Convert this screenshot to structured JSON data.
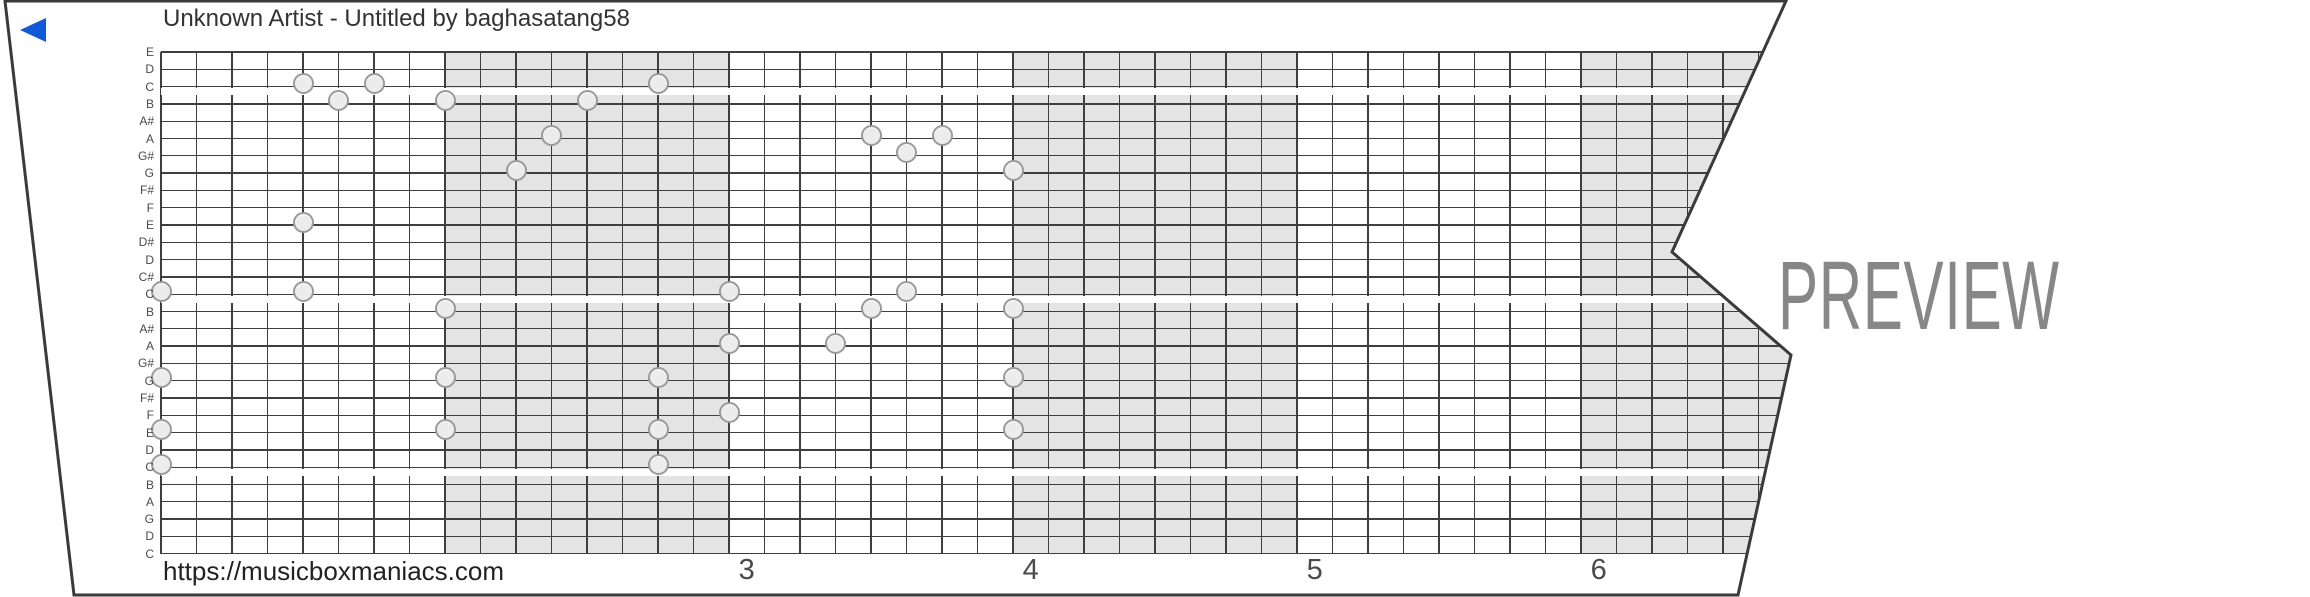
{
  "title": "Unknown Artist - Untitled by baghasatang58",
  "watermark": "PREVIEW",
  "footer_url": "https://musicboxmaniacs.com",
  "play_button": {
    "name": "play",
    "color": "#1259d8"
  },
  "colors": {
    "paper_border": "#3a3a3a",
    "grid_line": "#3f3f3f",
    "measure_shading": "#e4e4e4",
    "note_fill": "#ececec",
    "note_border": "#9a9a9a",
    "label_text": "#4a4a4a",
    "watermark_text": "#878787",
    "title_text": "#333333"
  },
  "strip": {
    "pitch_labels": [
      "E",
      "D",
      "C",
      "B",
      "A#",
      "A",
      "G#",
      "G",
      "F#",
      "F",
      "E",
      "D#",
      "D",
      "C#",
      "C",
      "B",
      "A#",
      "A",
      "G#",
      "G",
      "F#",
      "F",
      "E",
      "D",
      "C",
      "B",
      "A",
      "G",
      "D",
      "C"
    ],
    "octave_stripe_rows": [
      2,
      14,
      24
    ],
    "shaded_measures": [
      {
        "from_col": 8,
        "to_col": 16
      },
      {
        "from_col": 24,
        "to_col": 32
      },
      {
        "from_col": 40,
        "to_col": 47
      }
    ],
    "measure_numbers": [
      {
        "label": "3",
        "col": 16.5
      },
      {
        "label": "4",
        "col": 24.5
      },
      {
        "label": "5",
        "col": 32.5
      },
      {
        "label": "6",
        "col": 40.5
      }
    ],
    "notes": [
      {
        "col": 0,
        "row": 14,
        "pitch": "C"
      },
      {
        "col": 0,
        "row": 19,
        "pitch": "G"
      },
      {
        "col": 0,
        "row": 22,
        "pitch": "E"
      },
      {
        "col": 0,
        "row": 24,
        "pitch": "C"
      },
      {
        "col": 4,
        "row": 2,
        "pitch": "C"
      },
      {
        "col": 4,
        "row": 10,
        "pitch": "E"
      },
      {
        "col": 4,
        "row": 14,
        "pitch": "C"
      },
      {
        "col": 5,
        "row": 3,
        "pitch": "B"
      },
      {
        "col": 6,
        "row": 2,
        "pitch": "C"
      },
      {
        "col": 8,
        "row": 3,
        "pitch": "B"
      },
      {
        "col": 8,
        "row": 15,
        "pitch": "B"
      },
      {
        "col": 8,
        "row": 19,
        "pitch": "G"
      },
      {
        "col": 8,
        "row": 22,
        "pitch": "E"
      },
      {
        "col": 10,
        "row": 7,
        "pitch": "G"
      },
      {
        "col": 11,
        "row": 5,
        "pitch": "A"
      },
      {
        "col": 12,
        "row": 3,
        "pitch": "B"
      },
      {
        "col": 14,
        "row": 2,
        "pitch": "C"
      },
      {
        "col": 14,
        "row": 19,
        "pitch": "G"
      },
      {
        "col": 14,
        "row": 22,
        "pitch": "E"
      },
      {
        "col": 14,
        "row": 24,
        "pitch": "C"
      },
      {
        "col": 16,
        "row": 14,
        "pitch": "C"
      },
      {
        "col": 16,
        "row": 17,
        "pitch": "A"
      },
      {
        "col": 16,
        "row": 21,
        "pitch": "F"
      },
      {
        "col": 19,
        "row": 17,
        "pitch": "A"
      },
      {
        "col": 20,
        "row": 5,
        "pitch": "A"
      },
      {
        "col": 20,
        "row": 15,
        "pitch": "B"
      },
      {
        "col": 21,
        "row": 6,
        "pitch": "G#"
      },
      {
        "col": 21,
        "row": 14,
        "pitch": "C"
      },
      {
        "col": 22,
        "row": 5,
        "pitch": "A"
      },
      {
        "col": 24,
        "row": 7,
        "pitch": "G"
      },
      {
        "col": 24,
        "row": 15,
        "pitch": "B"
      },
      {
        "col": 24,
        "row": 19,
        "pitch": "G"
      },
      {
        "col": 24,
        "row": 22,
        "pitch": "E"
      }
    ]
  }
}
